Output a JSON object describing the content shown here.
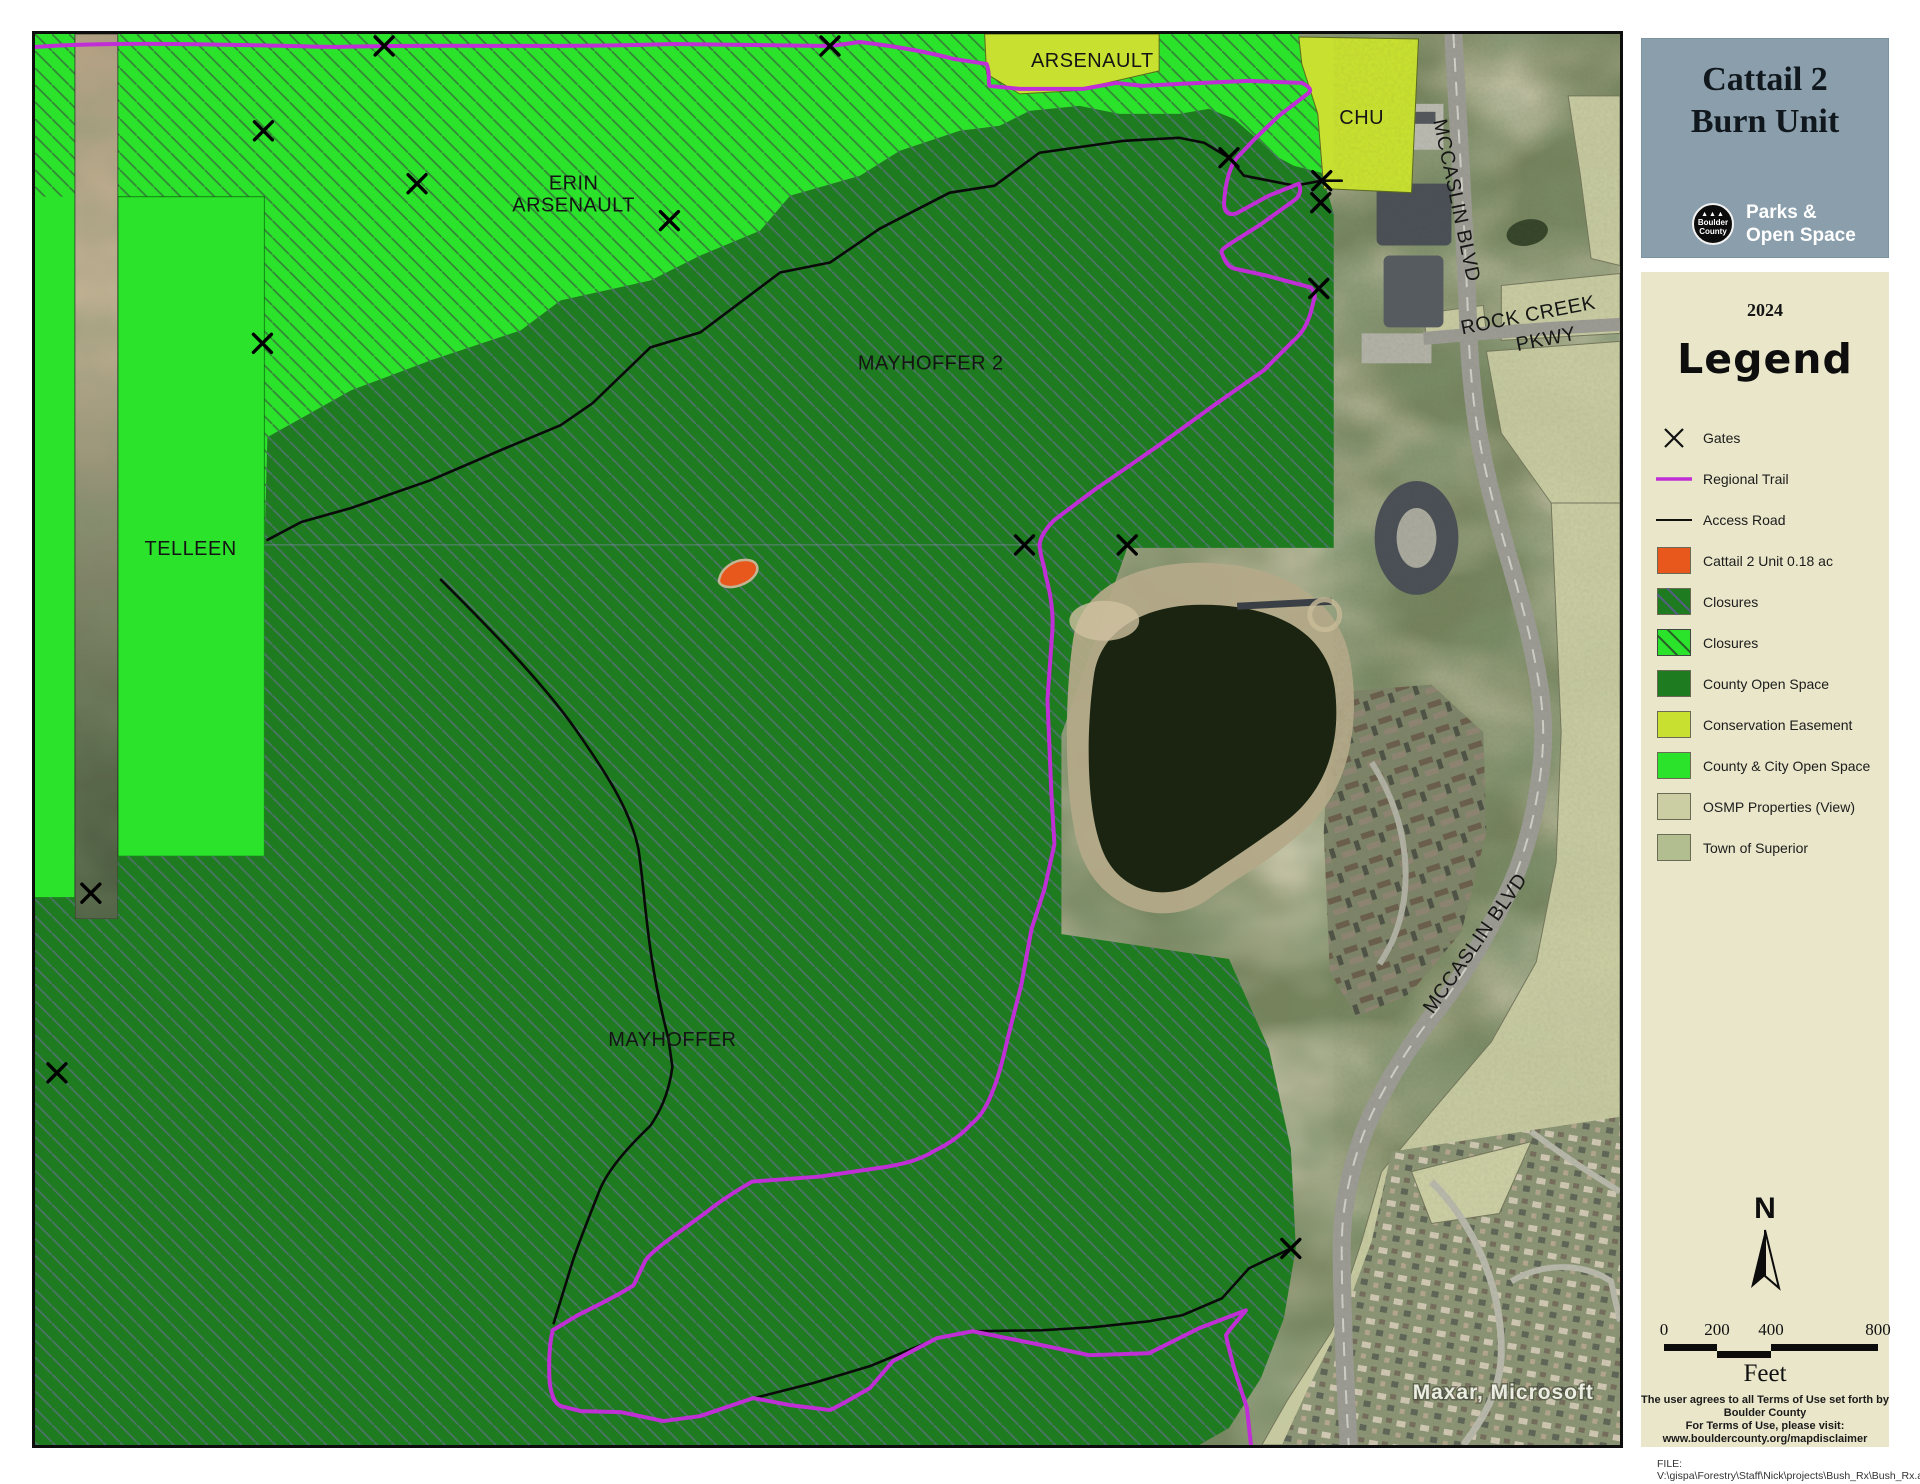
{
  "header": {
    "title_line1": "Cattail 2",
    "title_line2": "Burn Unit",
    "logo_line1": "Boulder",
    "logo_line2": "County",
    "dept_line1": "Parks &",
    "dept_line2": "Open Space"
  },
  "legend": {
    "year": "2024",
    "heading": "Legend",
    "symbol_items": [
      {
        "label": "Gates"
      },
      {
        "label": "Regional Trail",
        "color": "#C02ED6"
      },
      {
        "label": "Access Road",
        "color": "#111111"
      }
    ],
    "swatch_items": [
      {
        "label": "Cattail 2 Unit 0.18 ac",
        "fill": "#E8571C"
      },
      {
        "label": "Closures",
        "fill": "#1E7B20"
      },
      {
        "label": "Closures",
        "fill": "#2BE32B"
      },
      {
        "label": "County Open Space",
        "fill": "#1E7B20"
      },
      {
        "label": "Conservation Easement",
        "fill": "#C8E02F"
      },
      {
        "label": "County & City Open Space",
        "fill": "#2BE32B"
      },
      {
        "label": "OSMP Properties (View)",
        "fill": "#CBCDA3"
      },
      {
        "label": "Town of Superior",
        "fill": "#B2BD90"
      }
    ],
    "north_label": "N",
    "scale_ticks": [
      "0",
      "200",
      "400",
      "800"
    ],
    "scale_unit": "Feet",
    "disclaimer_line1": "The user agrees to all Terms of Use set forth by Boulder County",
    "disclaimer_line2": "For Terms of Use, please visit: www.bouldercounty.org/mapdisclaimer",
    "file_line": "FILE: V:\\gispa\\Forestry\\Staff\\Nick\\projects\\Bush_Rx\\Bush_Rx.aprx"
  },
  "map": {
    "labels": {
      "arsenault": "ARSENAULT",
      "chu": "CHU",
      "erin_line1": "ERIN",
      "erin_line2": "ARSENAULT",
      "mayhoffer2": "MAYHOFFER 2",
      "telleen": "TELLEEN",
      "mayhoffer": "MAYHOFFER",
      "mccaslin_top": "MCCASLIN BLVD",
      "rock_creek_line1": "ROCK CREEK",
      "rock_creek_line2": "PKWY",
      "mccaslin_bottom": "MCCASLIN BLVD",
      "attribution": "Maxar, Microsoft"
    }
  }
}
